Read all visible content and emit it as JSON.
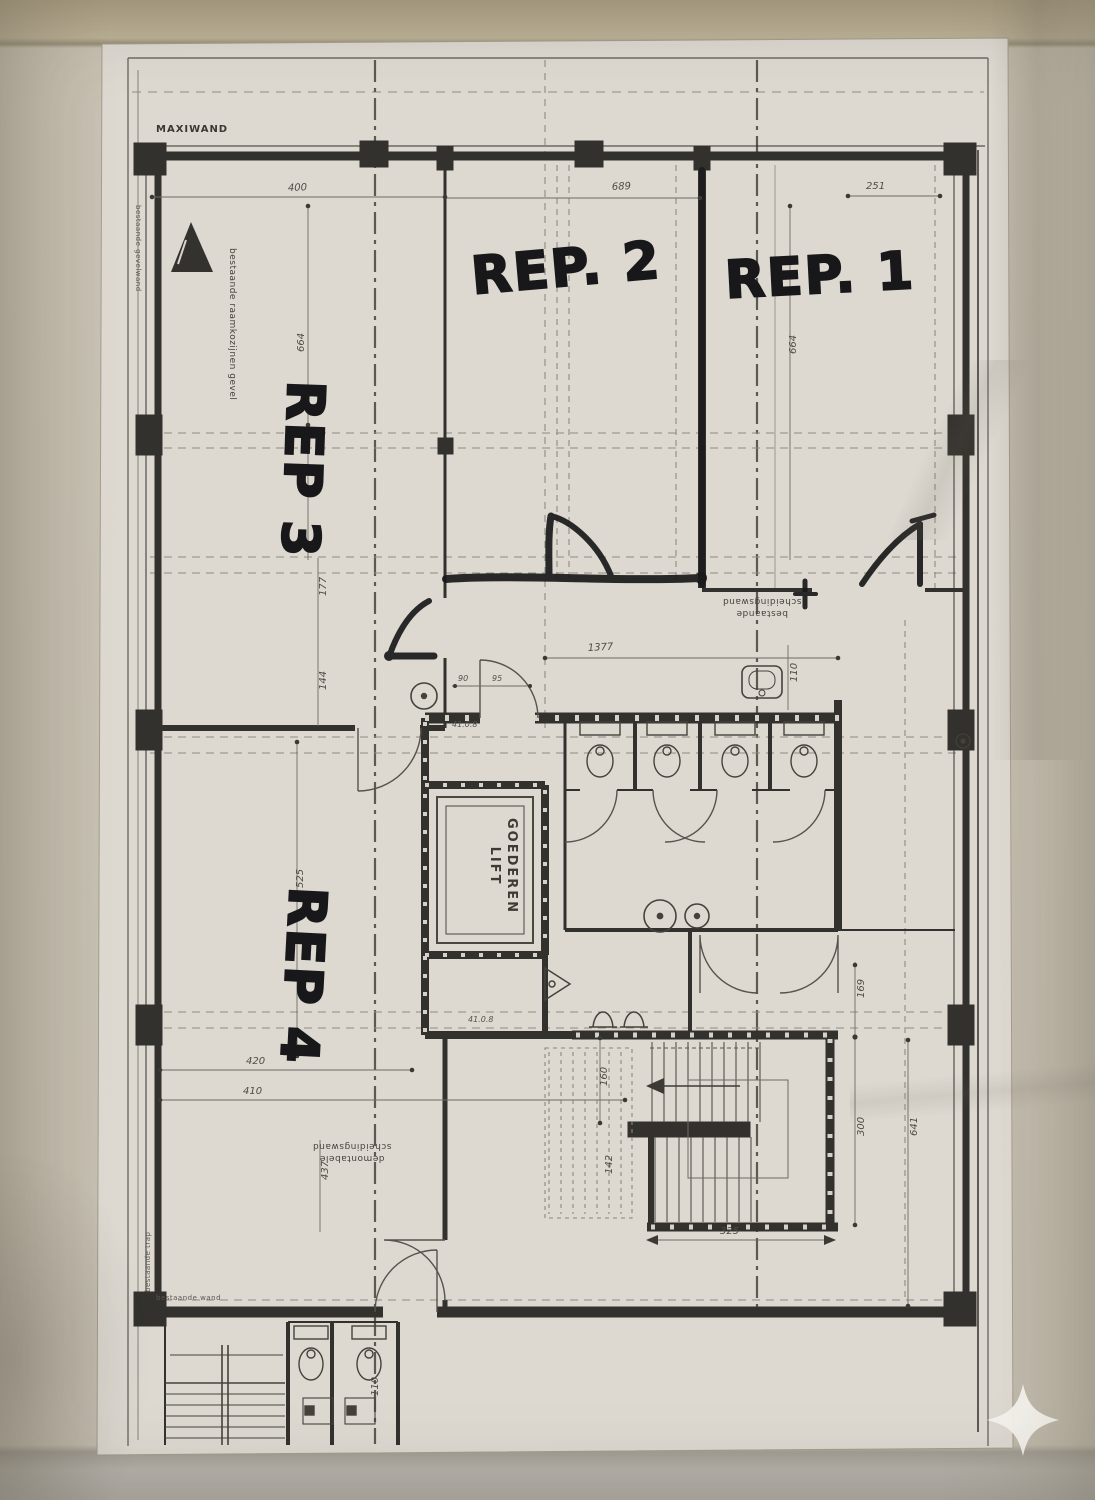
{
  "photo": {
    "description": "photo of a scanned architectural floor plan sheet"
  },
  "rooms": {
    "rep1": "REP. 1",
    "rep2": "REP. 2",
    "rep3": "REP 3",
    "rep4": "REP 4"
  },
  "lift": {
    "line1": "GOEDEREN",
    "line2": "LIFT"
  },
  "wall_label": "MAXIWAND",
  "room_codes": {
    "upper": "41.0.8",
    "lower": "41.0.8"
  },
  "notes": {
    "left_window": "bestaande raamkozijnen gevel",
    "far_left": "bestaande gevelwand",
    "center_1": "bestaande",
    "center_2": "scheidingswand",
    "rep4_1": "demontabele",
    "rep4_2": "scheidingswand",
    "bottom": "bestaande wand",
    "bottom_side": "bestaande trap"
  },
  "dims": {
    "d400": "400",
    "d689": "689",
    "d251": "251",
    "d664l": "664",
    "d664r": "664",
    "d177": "177",
    "d144": "144",
    "d1377": "1377",
    "d110a": "110",
    "d90": "90",
    "d95": "95",
    "d525": "525",
    "d420": "420",
    "d410": "410",
    "d437": "437",
    "d160": "160",
    "d142": "142",
    "d169": "169",
    "d300": "300",
    "d641": "641",
    "d325": "325",
    "d110b": "110"
  },
  "watermark": {
    "icon": "sparkle"
  },
  "colors": {
    "paper": "#dbd7cf",
    "backing": "#b9ae93",
    "ink": "#33312d",
    "marker": "#18181a",
    "dim_text": "#4e4b44"
  }
}
